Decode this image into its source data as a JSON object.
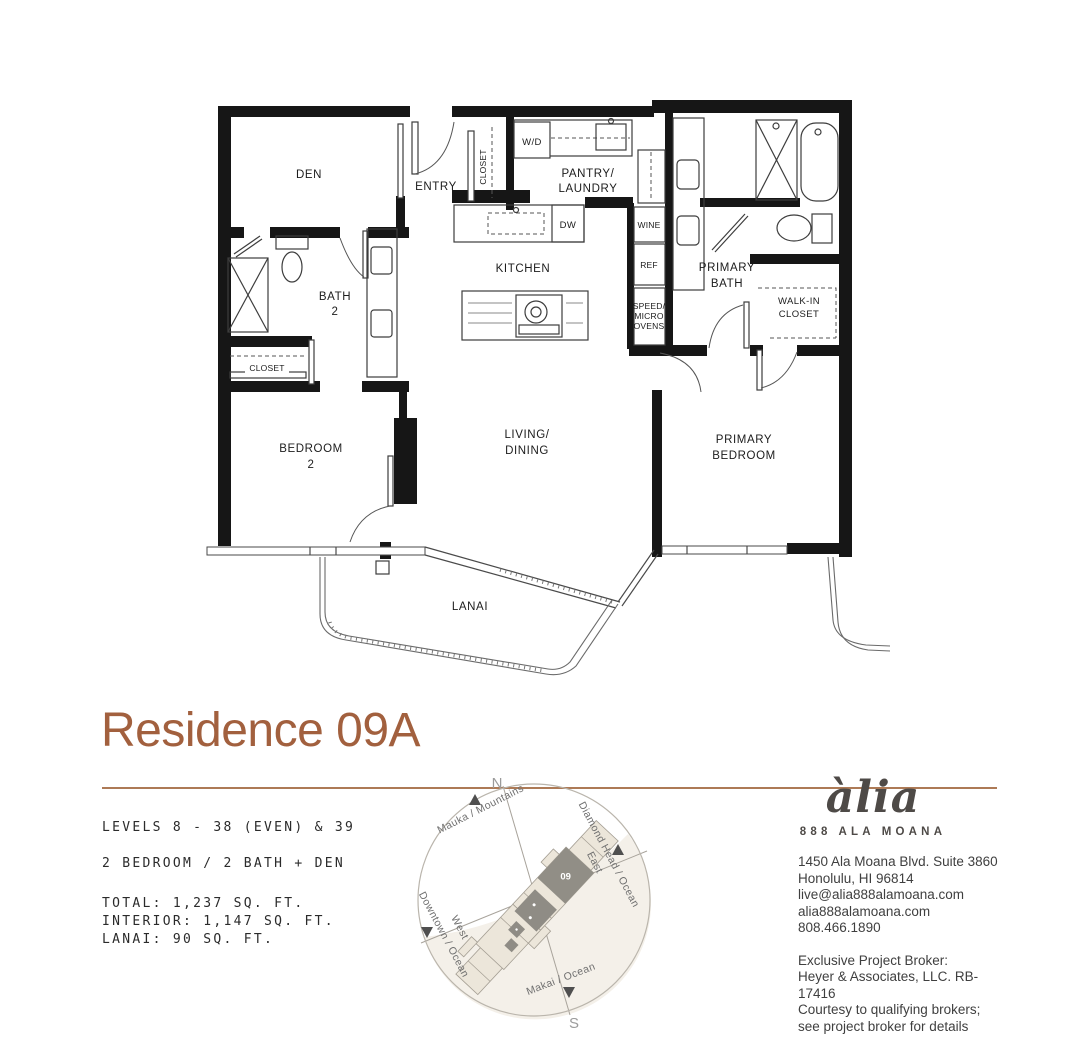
{
  "title": "Residence 09A",
  "colors": {
    "accent": "#a2603e",
    "rule": "#ad7a56",
    "wall": "#161616",
    "unit_highlight": "#918e86",
    "keyplan_shade": "#f4f0e9"
  },
  "plan": {
    "den": "DEN",
    "entry": "ENTRY",
    "entry_closet": "CLOSET",
    "wd": "W/D",
    "pantry_line1": "PANTRY/",
    "pantry_line2": "LAUNDRY",
    "kitchen": "KITCHEN",
    "dw": "DW",
    "wine": "WINE",
    "ref": "REF",
    "ovens_line1": "SPEED/",
    "ovens_line2": "MICRO",
    "ovens_line3": "OVENS",
    "bath2_line1": "BATH",
    "bath2_line2": "2",
    "bath2_closet": "CLOSET",
    "bedroom2_line1": "BEDROOM",
    "bedroom2_line2": "2",
    "living_line1": "LIVING/",
    "living_line2": "DINING",
    "primary_bath_line1": "PRIMARY",
    "primary_bath_line2": "BATH",
    "walkin_line1": "WALK-IN",
    "walkin_line2": "CLOSET",
    "primary_bedroom_line1": "PRIMARY",
    "primary_bedroom_line2": "BEDROOM",
    "lanai": "LANAI"
  },
  "details": {
    "levels": "LEVELS 8 - 38 (EVEN) & 39",
    "layout": "2 BEDROOM / 2 BATH + DEN",
    "total": "TOTAL: 1,237 SQ. FT.",
    "interior": "INTERIOR: 1,147 SQ. FT.",
    "lanai": "LANAI: 90 SQ. FT."
  },
  "compass": {
    "north": "N",
    "south": "S",
    "mauka": "Mauka / Mountains",
    "diamond_head_line1": "Diamond Head / Ocean",
    "diamond_head_line2": "East",
    "downtown_line1": "Downtown / Ocean",
    "downtown_line2": "West",
    "makai": "Makai / Ocean",
    "unit": "09"
  },
  "brand": {
    "logo": "àlia",
    "name": "888 ALA MOANA",
    "address_line1": "1450 Ala Moana Blvd. Suite 3860",
    "address_line2": "Honolulu, HI 96814",
    "email": "live@alia888alamoana.com",
    "website": "alia888alamoana.com",
    "phone": "808.466.1890",
    "broker_line1": "Exclusive Project Broker:",
    "broker_line2": "Heyer & Associates, LLC. RB-17416",
    "broker_line3": "Courtesy to qualifying brokers;",
    "broker_line4": "see project broker for details"
  }
}
